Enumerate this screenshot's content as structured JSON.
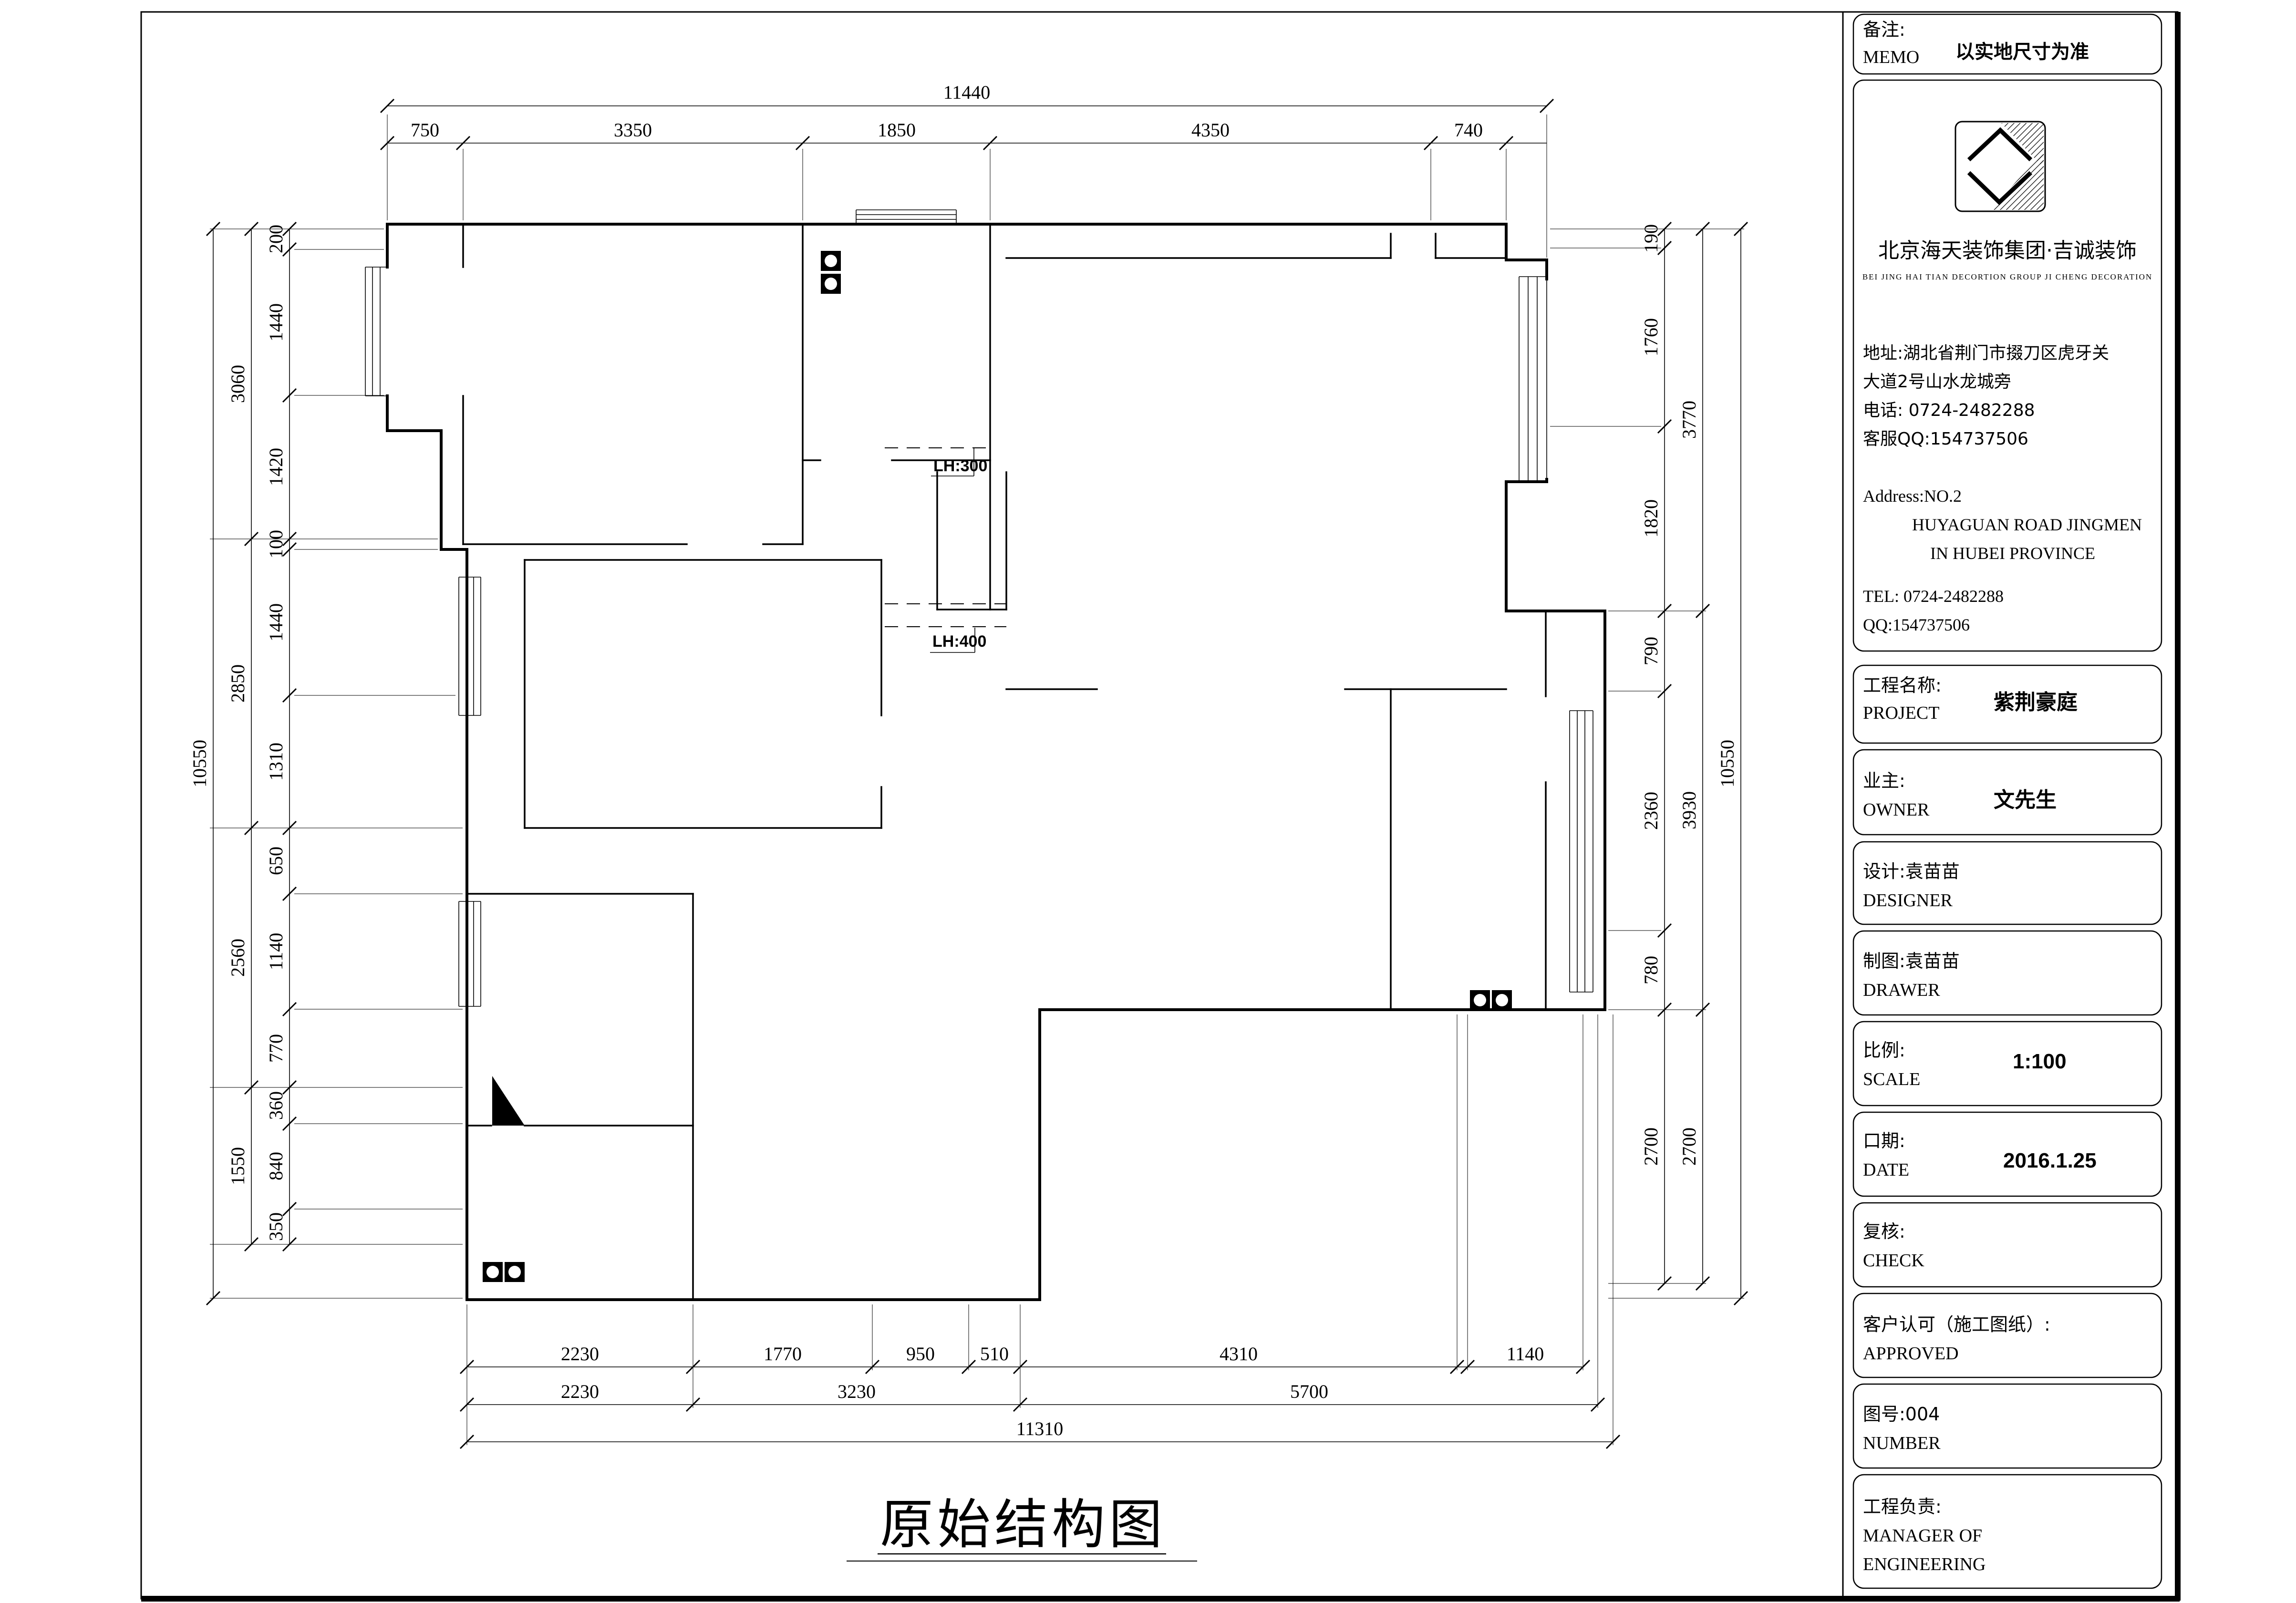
{
  "drawing_title": "原始结构图",
  "annotations": {
    "lh300": "LH:300",
    "lh400": "LH:400"
  },
  "dimensions": {
    "top": {
      "overall": "11440",
      "segments": [
        "750",
        "3350",
        "1850",
        "4350",
        "740"
      ]
    },
    "left": {
      "overall": "10550",
      "groups": [
        "3060",
        "2850",
        "2560",
        "1550"
      ],
      "segments": [
        "200",
        "1440",
        "1420",
        "100",
        "1440",
        "1310",
        "650",
        "1140",
        "770",
        "360",
        "840",
        "350"
      ]
    },
    "right": {
      "overall": "10550",
      "groups": [
        "3770",
        "3930",
        "2700"
      ],
      "segments": [
        "190",
        "1760",
        "1820",
        "790",
        "2360",
        "780",
        "2700"
      ]
    },
    "bottom": {
      "overall": "11310",
      "row1": [
        "2230",
        "1770",
        "950",
        "510",
        "4310",
        "1140"
      ],
      "row2": [
        "2230",
        "3230",
        "5700"
      ]
    }
  },
  "title_block": {
    "memo": {
      "label_cn": "备注:",
      "label_en": "MEMO",
      "value": "以实地尺寸为准"
    },
    "company": {
      "name": "北京海天装饰集团·吉诚装饰",
      "name_en": "BEI JING HAI TIAN DECORTION GROUP JI CHENG DECORATION",
      "address_cn_1": "地址:湖北省荆门市掇刀区虎牙关",
      "address_cn_2": "大道2号山水龙城旁",
      "phone_cn": "电话: 0724-2482288",
      "qq_cn": "客服QQ:154737506",
      "address_en_1": "Address:NO.2",
      "address_en_2": "HUYAGUAN ROAD JINGMEN",
      "address_en_3": "IN HUBEI PROVINCE",
      "tel_en": "TEL: 0724-2482288",
      "qq_en": "QQ:154737506"
    },
    "project": {
      "label_cn": "工程名称:",
      "label_en": "PROJECT",
      "value": "紫荆豪庭"
    },
    "owner": {
      "label_cn": "业主:",
      "label_en": "OWNER",
      "value": "文先生"
    },
    "designer": {
      "label_cn": "设计:袁苗苗",
      "label_en": "DESIGNER"
    },
    "drawer": {
      "label_cn": "制图:袁苗苗",
      "label_en": "DRAWER"
    },
    "scale": {
      "label_cn": "比例:",
      "label_en": "SCALE",
      "value": "1:100"
    },
    "date": {
      "label_cn": "口期:",
      "label_en": "DATE",
      "value": "2016.1.25"
    },
    "check": {
      "label_cn": "复核:",
      "label_en": "CHECK"
    },
    "approved": {
      "label_cn": "客户认可（施工图纸）:",
      "label_en": "APPROVED"
    },
    "number": {
      "label_cn": "图号:004",
      "label_en": "NUMBER"
    },
    "manager": {
      "label_cn": "工程负责:",
      "label_en_1": "MANAGER OF",
      "label_en_2": "ENGINEERING"
    }
  }
}
